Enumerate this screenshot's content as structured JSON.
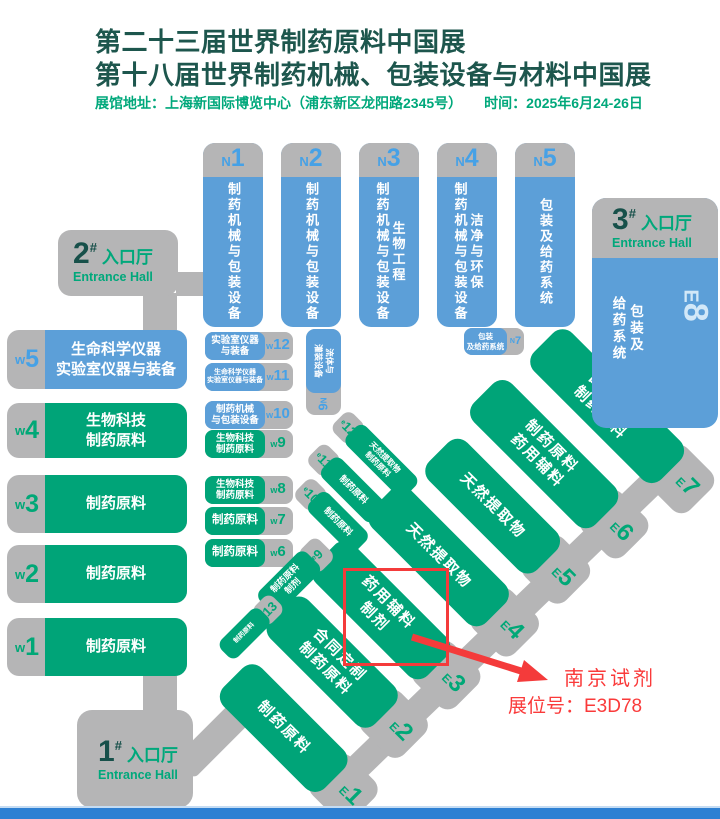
{
  "header": {
    "title1": "第二十三届世界制药原料中国展",
    "title2": "第十八届世界制药机械、包装设备与材料中国展",
    "venue": "展馆地址：上海新国际博览中心（浦东新区龙阳路2345号）",
    "time": "时间：2025年6月24-26日"
  },
  "entrances": [
    {
      "num": "1",
      "hash": "#",
      "cn": "入口厅",
      "en": "Entrance Hall"
    },
    {
      "num": "2",
      "hash": "#",
      "cn": "入口厅",
      "en": "Entrance Hall"
    },
    {
      "num": "3",
      "hash": "#",
      "cn": "入口厅",
      "en": "Entrance Hall"
    }
  ],
  "north_halls": [
    {
      "prefix": "N",
      "num": "1",
      "lines": [
        "制药机械与包装设备"
      ]
    },
    {
      "prefix": "N",
      "num": "2",
      "lines": [
        "制药机械与包装设备"
      ]
    },
    {
      "prefix": "N",
      "num": "3",
      "lines": [
        "制药机械与包装设备",
        "生物工程"
      ]
    },
    {
      "prefix": "N",
      "num": "4",
      "lines": [
        "制药机械与包装设备",
        "洁净与环保"
      ]
    },
    {
      "prefix": "N",
      "num": "5",
      "lines": [
        "包装及给药系统"
      ]
    }
  ],
  "east8": {
    "prefix": "E",
    "num": "8",
    "lines": [
      "包装及",
      "给药系统"
    ]
  },
  "west_halls": [
    {
      "prefix": "w",
      "num": "5",
      "lines": [
        "生命科学仪器",
        "实验室仪器与装备"
      ],
      "scheme": "blue"
    },
    {
      "prefix": "w",
      "num": "4",
      "lines": [
        "生物科技",
        "制药原料"
      ],
      "scheme": "green"
    },
    {
      "prefix": "w",
      "num": "3",
      "lines": [
        "制药原料"
      ],
      "scheme": "green"
    },
    {
      "prefix": "w",
      "num": "2",
      "lines": [
        "制药原料"
      ],
      "scheme": "green"
    },
    {
      "prefix": "w",
      "num": "1",
      "lines": [
        "制药原料"
      ],
      "scheme": "green"
    }
  ],
  "west_mezz": [
    {
      "prefix": "w",
      "num": "12",
      "lines": [
        "实验室仪器",
        "与装备"
      ],
      "scheme": "blue"
    },
    {
      "prefix": "w",
      "num": "11",
      "lines": [
        "生命科学仪器",
        "实验室仪器与装备"
      ],
      "scheme": "blue"
    },
    {
      "prefix": "w",
      "num": "10",
      "lines": [
        "制药机械",
        "与包装设备"
      ],
      "scheme": "blue"
    },
    {
      "prefix": "w",
      "num": "9",
      "lines": [
        "生物科技",
        "制药原料"
      ],
      "scheme": "green"
    },
    {
      "prefix": "w",
      "num": "8",
      "lines": [
        "生物科技",
        "制药原料"
      ],
      "scheme": "green"
    },
    {
      "prefix": "w",
      "num": "7",
      "lines": [
        "制药原料"
      ],
      "scheme": "green"
    },
    {
      "prefix": "w",
      "num": "6",
      "lines": [
        "制药原料"
      ],
      "scheme": "green"
    }
  ],
  "north_mezz": [
    {
      "prefix": "N",
      "num": "6",
      "lines": [
        "流体与",
        "灌装设备"
      ]
    },
    {
      "prefix": "N",
      "num": "7",
      "lines": [
        "包装",
        "及给药系统"
      ]
    }
  ],
  "east_halls": [
    {
      "prefix": "E",
      "num": "1",
      "lines": [
        "制药原料"
      ]
    },
    {
      "prefix": "E",
      "num": "2",
      "lines": [
        "合同定制",
        "制药原料"
      ]
    },
    {
      "prefix": "E",
      "num": "3",
      "lines": [
        "药用辅料",
        "制剂"
      ]
    },
    {
      "prefix": "E",
      "num": "4",
      "lines": [
        "天然提取物"
      ]
    },
    {
      "prefix": "E",
      "num": "5",
      "lines": [
        "天然提取物"
      ]
    },
    {
      "prefix": "E",
      "num": "6",
      "lines": [
        "制药原料",
        "药用辅料"
      ]
    },
    {
      "prefix": "E",
      "num": "7",
      "lines": [
        "合同定制",
        "制药原料"
      ]
    }
  ],
  "east_mezz": [
    {
      "prefix": "e",
      "num": "9",
      "lines": [
        "制药原料",
        "制剂"
      ]
    },
    {
      "prefix": "e",
      "num": "10",
      "lines": [
        "制药原料"
      ]
    },
    {
      "prefix": "e",
      "num": "11",
      "lines": [
        "制药原料"
      ]
    },
    {
      "prefix": "e",
      "num": "12",
      "lines": [
        "天然提取物",
        "制药原料"
      ]
    },
    {
      "prefix": "e",
      "num": "13",
      "lines": [
        "制药原料"
      ]
    }
  ],
  "annotation": {
    "company": "南京试剂",
    "booth": "展位号：E3D78"
  },
  "colors": {
    "hall_blue": "#5C9FD8",
    "hall_green": "#00A478",
    "hall_gray": "#B5B5B6",
    "label_blue": "#46A1E6",
    "label_green": "#00A877",
    "title_dark_teal": "#1D564D",
    "address_green": "#00A87B",
    "entrance_number": "#17504A",
    "highlight_red": "#F43B3B",
    "footer_blue": "#2E80D3",
    "e8_label_light": "#D2E8F8"
  }
}
